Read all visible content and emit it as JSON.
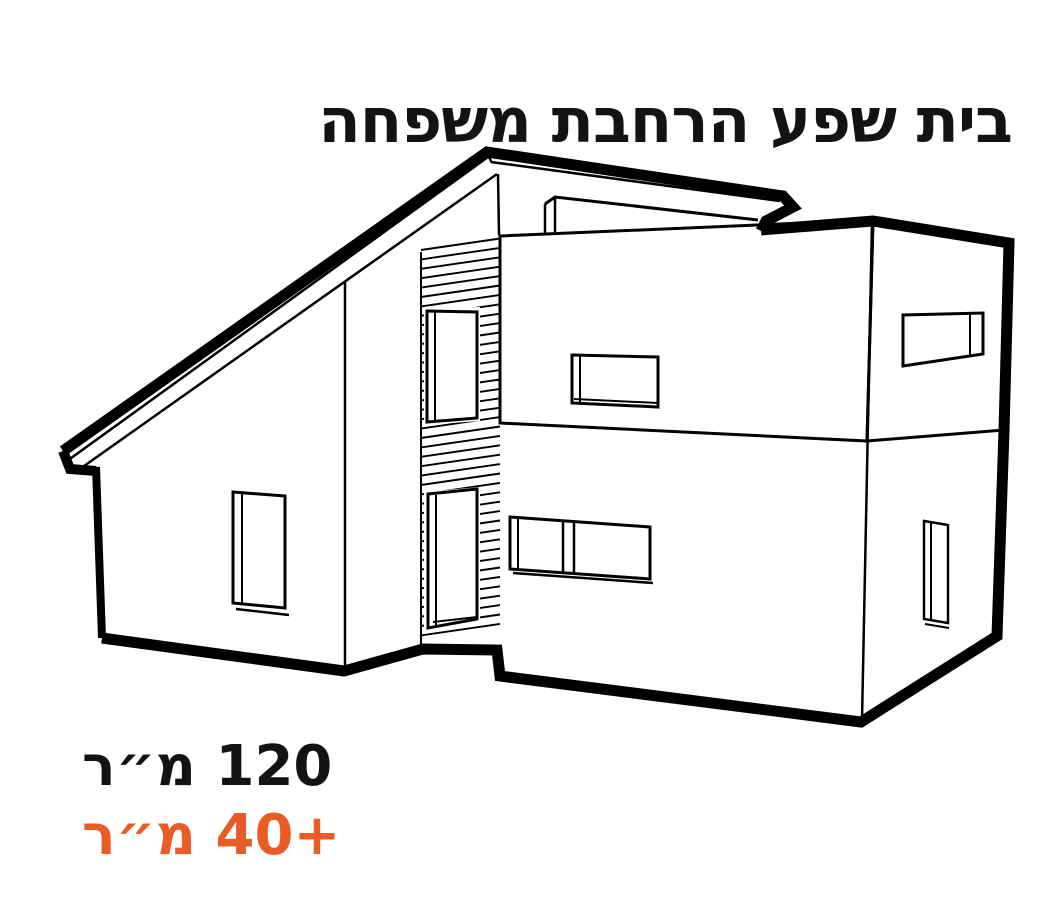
{
  "title": "בית שפע הרחבת משפחה",
  "stats": {
    "existing_area": "120 מ״ר",
    "addition_area": "+40 מ״ר"
  },
  "colors": {
    "accent": "#EA5C26",
    "ink": "#131313",
    "line": "#000000",
    "background": "#FFFFFF"
  }
}
